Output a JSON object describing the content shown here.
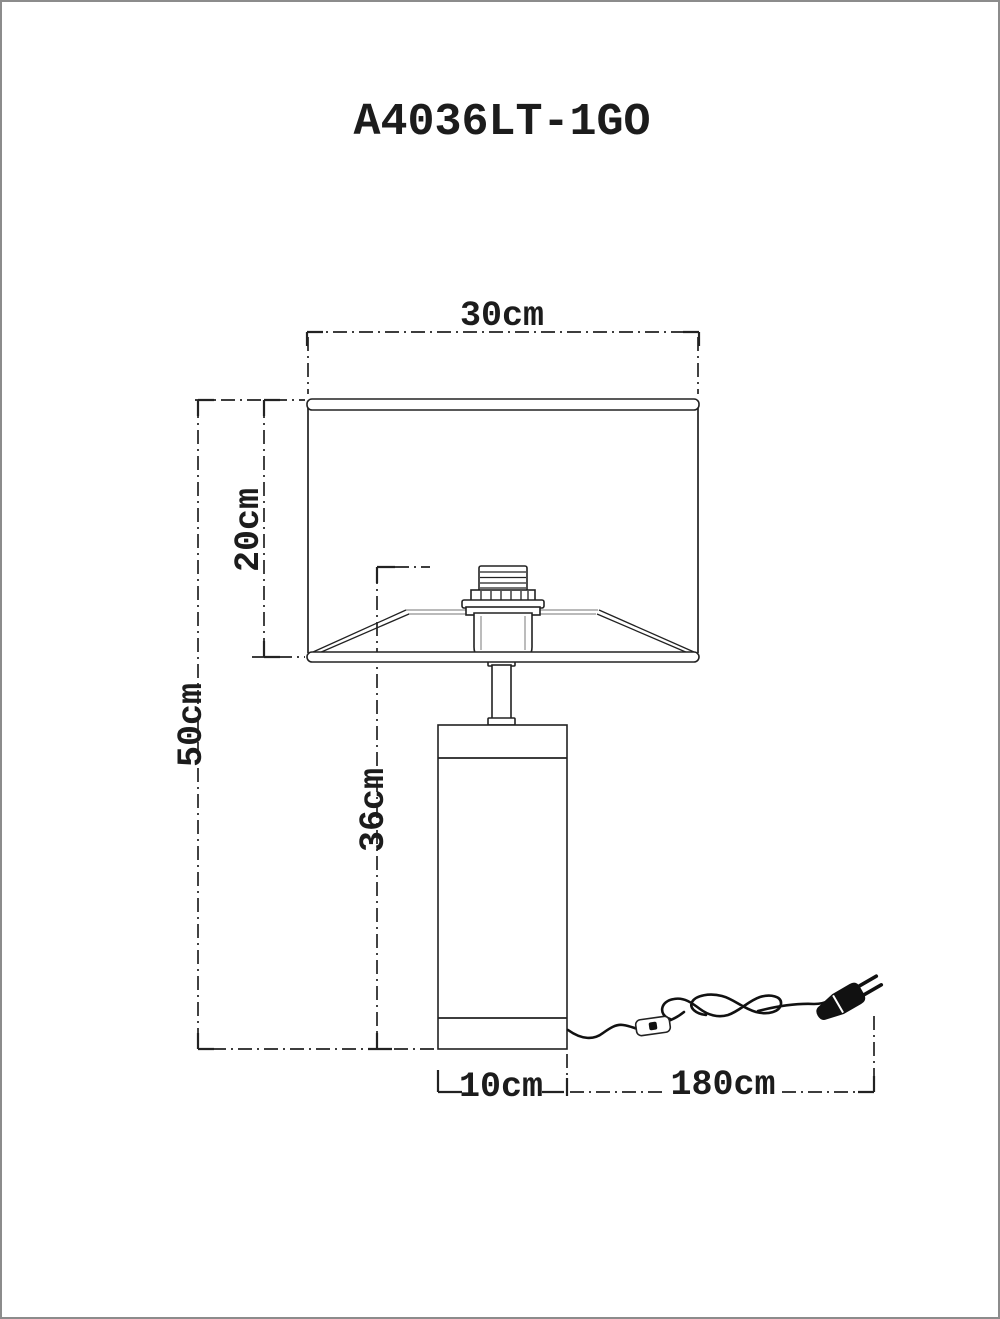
{
  "title": "A4036LT-1GO",
  "dimensions": {
    "shade_width": "30cm",
    "shade_height": "20cm",
    "total_height": "50cm",
    "body_to_socket_height": "36cm",
    "base_width": "10cm",
    "cord_length": "180cm"
  },
  "colors": {
    "background": "#ffffff",
    "line": "#222222",
    "light_line": "#909090",
    "page_border": "#8c8c8c"
  }
}
